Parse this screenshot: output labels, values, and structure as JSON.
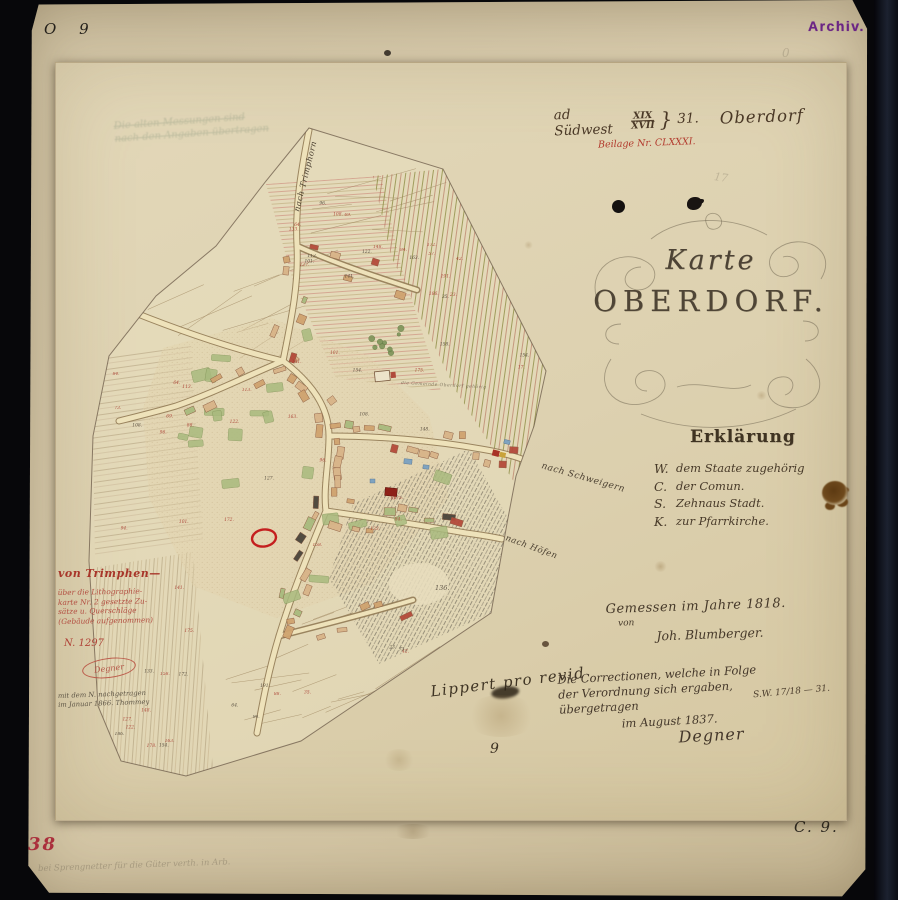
{
  "marks": {
    "top_left": "O 9",
    "archive_stamp": "Archiv.",
    "bottom_left_red": "38",
    "bottom_left_pencil": "bei Sprengnetter für die Güter verth. in Arb.",
    "bottom_center": "9",
    "bottom_right": "C. 9.",
    "pencil_top": "17",
    "pencil_right": "0"
  },
  "header": {
    "prefix": "ad Südwest",
    "frac_top": "XIX",
    "frac_bottom": "XVII",
    "brace": "}",
    "number": "31.",
    "place": "Oberdorf",
    "red_note": "Beilage Nr. CLXXXI."
  },
  "title": {
    "line1": "Karte",
    "line2": "OBERDORF."
  },
  "legend": {
    "heading": "Erklärung",
    "items": [
      {
        "symbol": "W.",
        "label": "dem Staate zugehörig"
      },
      {
        "symbol": "C.",
        "label": "der Comun."
      },
      {
        "symbol": "S.",
        "label": "Zehnaus Stadt."
      },
      {
        "symbol": "K.",
        "label": "zur Pfarrkirche."
      }
    ]
  },
  "survey": {
    "line1": "Gemessen im Jahre 1818.",
    "line2": "von",
    "line3": "Joh. Blumberger."
  },
  "correction": {
    "lines": [
      "Die Correctionen, welche in Folge",
      "der Verordnung sich ergaben,",
      "übergetragen"
    ],
    "date_line": "im August 1837.",
    "signature": "Degner",
    "side_ref": "S.W. 17/18 — 31."
  },
  "revision_note": "Lippert pro revid",
  "margin_note": {
    "heading": "von Trimphen—",
    "red_lines": [
      "über die Lithographie-",
      "karte Nr. 2 gesetzte Zu-",
      "sätze u. Querschläge",
      "(Gebäude aufgenommen)"
    ],
    "number": "N. 1297",
    "stamp": "Degner",
    "black_lines": [
      "mit dem N. nachgetragen",
      "im Januar 1866. Thommey"
    ]
  },
  "faint_note": {
    "line1": "Die alten Messungen sind",
    "line2": "nach den Angaben übertragen"
  },
  "map": {
    "edge_labels": [
      "nach Trimphorn",
      "nach Schweigern",
      "nach Höfen"
    ],
    "area_label": "die Gemeinde Oberdorf gehörig",
    "slope_number": "136.",
    "field_numbers": [
      "64.",
      "69.",
      "84.",
      "96.",
      "101.",
      "108.",
      "113.",
      "122.",
      "127.",
      "133.",
      "141.",
      "148.",
      "154.",
      "158.",
      "163.",
      "172.",
      "175.",
      "178.",
      "186.",
      "191.",
      "17.",
      "23.",
      "35.",
      "42.",
      "57.",
      "73.",
      "88.",
      "94."
    ],
    "palette": {
      "field_line": "#a28a64",
      "garden": "#a9ba7e",
      "garden_line": "#7c8f54",
      "bldg1": "#d8b488",
      "bldg2": "#cfa36f",
      "bldg_red": "#b44a3a",
      "bldg_dark": "#4a443a",
      "bldg_line": "#8a5a40",
      "tree": "#7d9458",
      "tree_line": "#55703c",
      "num_red": "#a8392e",
      "num_black": "#4a4034",
      "label_ink": "#43382a"
    }
  }
}
